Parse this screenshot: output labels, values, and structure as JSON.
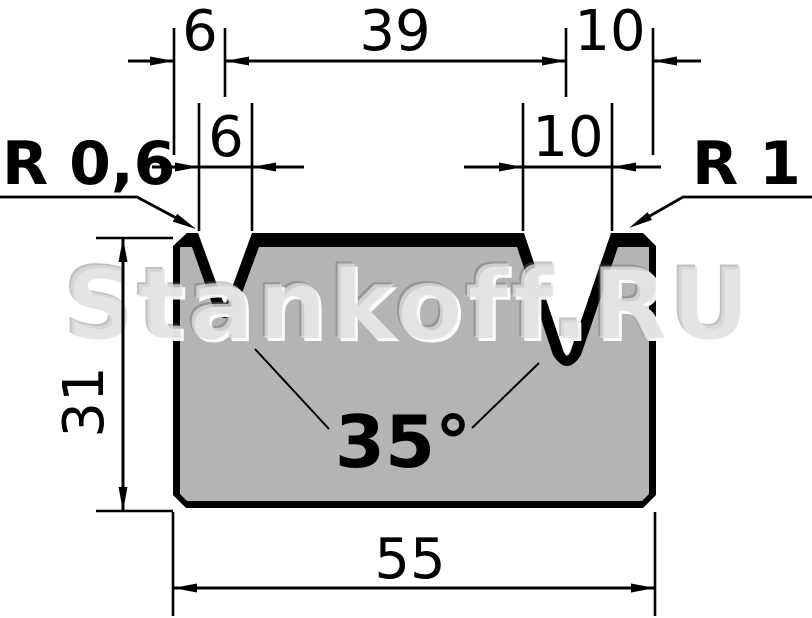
{
  "watermark": {
    "text": "Stankoff.RU"
  },
  "labels": {
    "radius_left": "R 0,6",
    "radius_right": "R 1",
    "angle": "35°"
  },
  "dimensions": {
    "top_offset_left": "6",
    "top_span_center": "39",
    "top_offset_right": "10",
    "v_opening_left": "6",
    "v_opening_right": "10",
    "die_height": "31",
    "die_width": "55"
  },
  "colors": {
    "background": "#ffffff",
    "line": "#000000",
    "body_fill": "#b4b4b4",
    "outline_fill": "#000000",
    "watermark": "#dedede"
  }
}
